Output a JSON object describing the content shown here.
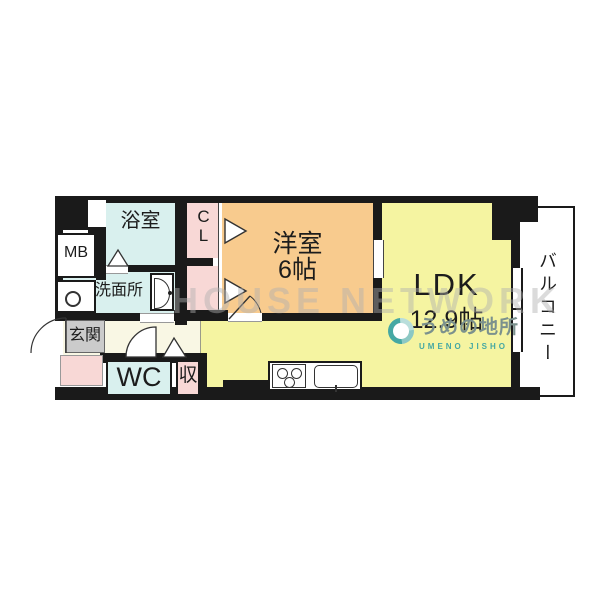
{
  "meta": {
    "type": "apartment-floor-plan",
    "watermark": "HOUSE NETWORK"
  },
  "colors": {
    "wall": "#1a1a1a",
    "blue": "#d9f0ee",
    "pink": "#f8d8d6",
    "orange": "#f8cb8e",
    "yellow": "#f5f4a1",
    "cream": "#f9f7e4",
    "tile": "#cbcbcb",
    "teal": "#45a8a3",
    "logo_gray": "#7b918d",
    "watermark": "#b0b0b0"
  },
  "rooms": {
    "bathroom": {
      "label": "浴室"
    },
    "closet": {
      "label": "C\nL"
    },
    "western": {
      "label": "洋室",
      "size": "6帖"
    },
    "ldk": {
      "label": "LDK",
      "size": "12.9帖"
    },
    "balcony": {
      "label": "バルコニー"
    },
    "washroom": {
      "label": "洗面所"
    },
    "entrance": {
      "label": "玄関"
    },
    "wc": {
      "label": "WC"
    },
    "storage": {
      "label": "収"
    },
    "meter_box": {
      "label": "MB"
    }
  },
  "logo": {
    "name_jp": "うめの地所",
    "name_en": "UMENO JISHO"
  }
}
